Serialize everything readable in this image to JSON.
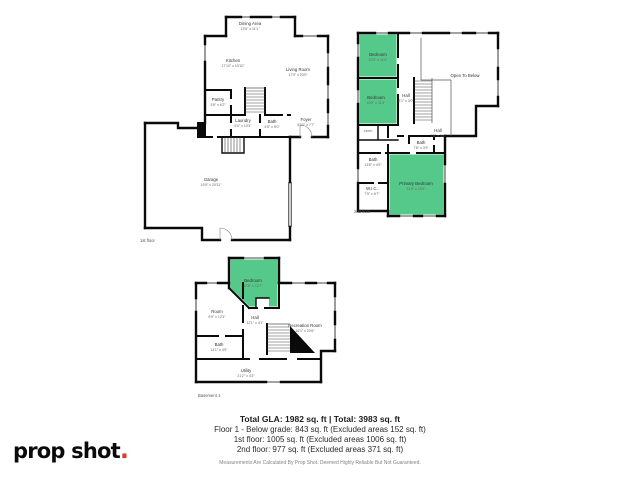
{
  "logo": {
    "brand": "prop shot",
    "dot": "."
  },
  "summary": {
    "total_line": "Total GLA: 1982 sq. ft | Total: 3983 sq. ft",
    "floor1_line": "Floor 1 - Below grade: 843 sq. ft (Excluded areas 152 sq. ft)",
    "first_floor_line": "1st floor: 1005 sq. ft (Excluded areas 1006 sq. ft)",
    "second_floor_line": "2nd floor: 977 sq. ft (Excluded areas 371 sq. ft)",
    "disclaimer": "Measurements Are Calculated By Prop Shot. Deemed Highly Reliable But Not Guaranteed."
  },
  "colors": {
    "wall": "#0a0a0a",
    "room_highlight": "#55c98a",
    "logo_dot": "#d43d30"
  },
  "floor_first": {
    "label": "1st floor",
    "rooms": {
      "dining": {
        "name": "Dining Area",
        "dims": "13'6\" x 11'1\""
      },
      "kitchen": {
        "name": "Kitchen",
        "dims": "17'10\" x 10'10\""
      },
      "living": {
        "name": "Living Room",
        "dims": "17'9\" x 20'0\""
      },
      "pantry": {
        "name": "Pantry",
        "dims": "3'8\" x 6'2\""
      },
      "laundry": {
        "name": "Laundry",
        "dims": "6'0\" x 10'4\""
      },
      "bath": {
        "name": "Bath",
        "dims": "4'6\" x 5'0\""
      },
      "foyer": {
        "name": "Foyer",
        "dims": "6'10\" x 7'7\""
      },
      "garage": {
        "name": "Garage",
        "dims": "19'5\" x 20'11\""
      }
    }
  },
  "floor_second": {
    "label": "2nd floor",
    "rooms": {
      "bedroom1": {
        "name": "Bedroom",
        "dims": "10'2\" x 11'4\""
      },
      "bedroom2": {
        "name": "Bedroom",
        "dims": "10'0\" x 11'3\""
      },
      "hall_upper": {
        "name": "Hall",
        "dims": "8'1\" x 3'0\""
      },
      "open_below": {
        "name": "Open To Below",
        "dims": ""
      },
      "linen": {
        "name": "Linen",
        "dims": ""
      },
      "hall_lower": {
        "name": "Hall",
        "dims": "7'8\" x 3'4\""
      },
      "bath1": {
        "name": "Bath",
        "dims": "7'8\" x 3'9\""
      },
      "bath2": {
        "name": "Bath",
        "dims": "13'8\" x 4'9\""
      },
      "wic": {
        "name": "W.I.C.",
        "dims": "7'5\" x 6'7\""
      },
      "primary": {
        "name": "Primary Bedroom",
        "dims": "14'9\" x 15'9\""
      }
    }
  },
  "floor_basement": {
    "label": "Basement 1",
    "rooms": {
      "bedroom": {
        "name": "Bedroom",
        "dims": "12'8\" x 12'7\""
      },
      "room": {
        "name": "Room",
        "dims": "9'9\" x 12'1\""
      },
      "hall": {
        "name": "Hall",
        "dims": "12'1\" x 4'1\""
      },
      "rec": {
        "name": "Recreation Room",
        "dims": "16'1\" x 20'6\""
      },
      "bath": {
        "name": "Bath",
        "dims": "14'1\" x 4'9\""
      },
      "utility": {
        "name": "Utility",
        "dims": "21'2\" x 4'3\""
      }
    }
  }
}
